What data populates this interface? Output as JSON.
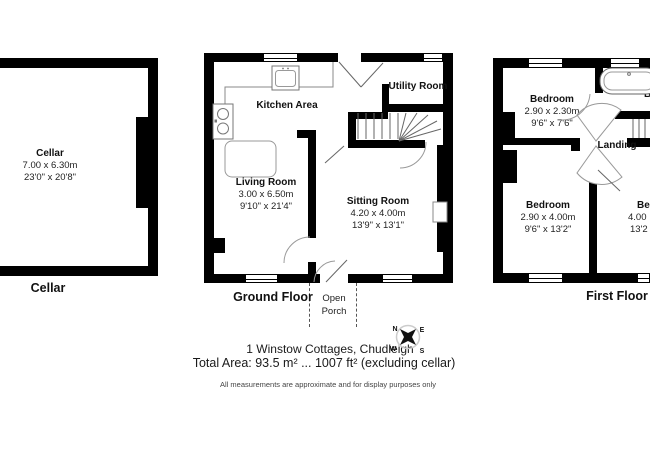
{
  "colors": {
    "wall": "#000000",
    "fixture_line": "#888888",
    "door_line": "#666666"
  },
  "cellar": {
    "title": "Cellar",
    "room": {
      "name": "Cellar",
      "metric": "7.00 x 6.30m",
      "imperial": "23'0\" x 20'8\""
    }
  },
  "ground_floor": {
    "title": "Ground Floor",
    "porch": {
      "line1": "Open",
      "line2": "Porch"
    },
    "rooms": {
      "kitchen": {
        "name": "Kitchen Area"
      },
      "utility": {
        "name": "Utility Room"
      },
      "living": {
        "name": "Living Room",
        "metric": "3.00 x 6.50m",
        "imperial": "9'10\" x 21'4\""
      },
      "sitting": {
        "name": "Sitting Room",
        "metric": "4.20 x 4.00m",
        "imperial": "13'9\" x 13'1\""
      }
    }
  },
  "first_floor": {
    "title": "First Floor",
    "rooms": {
      "bedroom_small": {
        "name": "Bedroom",
        "metric": "2.90 x 2.30m",
        "imperial": "9'6\" x 7'6\""
      },
      "bedroom_left": {
        "name": "Bedroom",
        "metric": "2.90 x 4.00m",
        "imperial": "9'6\" x 13'2\""
      },
      "landing": {
        "name": "Landing"
      },
      "bedroom_right_partial": {
        "name": "Be",
        "metric": "4.00",
        "imperial": "13'2"
      },
      "bathroom_partial": {
        "name": "B"
      }
    }
  },
  "footer": {
    "address": "1 Winstow Cottages, Chudleigh",
    "total_area": "Total Area: 93.5 m² ... 1007 ft² (excluding cellar)",
    "disclaimer": "All measurements are approximate and for display purposes only",
    "compass": {
      "n": "N",
      "e": "E",
      "w": "W",
      "s": "S"
    }
  }
}
